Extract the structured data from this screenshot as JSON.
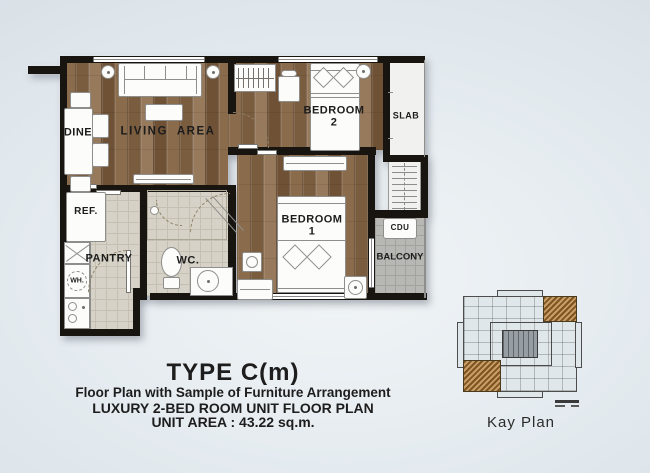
{
  "plan": {
    "rooms": {
      "dine": "DINE",
      "living": "LIVING  AREA",
      "bedroom2_name": "BEDROOM",
      "bedroom2_num": "2",
      "slab": "SLAB",
      "ref": "REF.",
      "pantry": "PANTRY",
      "wh": "WH.",
      "wc": "WC.",
      "bedroom1_name": "BEDROOM",
      "bedroom1_num": "1",
      "cdu": "CDU",
      "balcony": "BALCONY"
    }
  },
  "caption": {
    "title": "TYPE C(m)",
    "line2": "Floor Plan with Sample of Furniture Arrangement",
    "line3": "LUXURY 2-BED ROOM UNIT FLOOR PLAN",
    "line4": "UNIT AREA : 43.22 sq.m."
  },
  "key_plan": {
    "label": "Kay Plan"
  },
  "colors": {
    "wall": "#18140f",
    "wood": "#87684a",
    "tile": "#d6d2c7",
    "balcony_tile": "#b7b7b3",
    "highlight_unit": "#a97e3f",
    "background_corner": "#cbd5dd",
    "background_center": "#f1f5f7"
  }
}
